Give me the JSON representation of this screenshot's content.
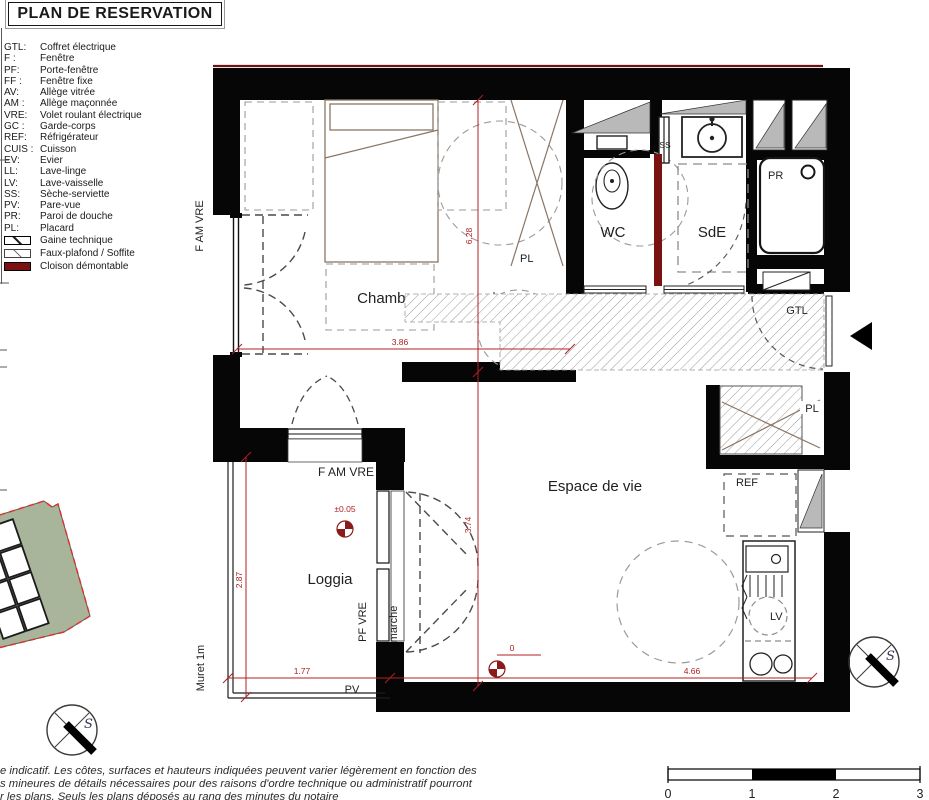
{
  "title": "PLAN DE RESERVATION",
  "legend": {
    "items": [
      {
        "abbr": "GTL:",
        "label": "Coffret électrique"
      },
      {
        "abbr": "F :",
        "label": "Fenêtre"
      },
      {
        "abbr": "PF:",
        "label": "Porte-fenêtre"
      },
      {
        "abbr": "FF :",
        "label": "Fenêtre fixe"
      },
      {
        "abbr": "AV:",
        "label": "Allège vitrée"
      },
      {
        "abbr": "AM :",
        "label": "Allège maçonnée"
      },
      {
        "abbr": "VRE:",
        "label": "Volet roulant électrique"
      },
      {
        "abbr": "GC :",
        "label": "Garde-corps"
      },
      {
        "abbr": "REF:",
        "label": "Réfrigérateur"
      },
      {
        "abbr": "CUIS :",
        "label": "Cuisson"
      },
      {
        "abbr": "EV:",
        "label": "Evier"
      },
      {
        "abbr": "LL:",
        "label": "Lave-linge"
      },
      {
        "abbr": "LV:",
        "label": "Lave-vaisselle"
      },
      {
        "abbr": "SS:",
        "label": "Sèche-serviette"
      },
      {
        "abbr": "PV:",
        "label": "Pare-vue"
      },
      {
        "abbr": "PR:",
        "label": "Paroi de douche"
      },
      {
        "abbr": "PL:",
        "label": "Placard"
      }
    ],
    "swatches": [
      {
        "label": "Gaine technique"
      },
      {
        "label": "Faux-plafond / Soffite"
      },
      {
        "label": "Cloison démontable"
      }
    ]
  },
  "plan": {
    "rooms": {
      "chambre": "Chambre",
      "wc": "WC",
      "sde": "SdE",
      "espace": "Espace de vie",
      "loggia": "Loggia"
    },
    "labels": {
      "f_am_vre_left": "F AM VRE",
      "f_am_vre_loggia": "F AM VRE",
      "pl_chambre": "PL",
      "ss": "SS",
      "pr": "PR",
      "gtl": "GTL",
      "pl_entree": "PL",
      "ref": "REF",
      "lv": "LV",
      "pv": "PV",
      "pf_vre": "PF VRE",
      "marche": "marche",
      "muret": "Muret 1m",
      "compass_s": "S"
    },
    "dims": {
      "d386": "3.86",
      "d628": "6.28",
      "d374": "3.74",
      "d287": "2.87",
      "d177": "1.77",
      "d466": "4.66",
      "lvl_loggia": "±0.05",
      "lvl_espace": "0"
    },
    "colors": {
      "wall": "#060606",
      "dim_red": "#b02020",
      "cloison_red": "#7a1212",
      "soffite_gray": "#b9b9b9",
      "furniture_brown": "#8a7565",
      "site_green": "#a9b59a",
      "site_boundary_red": "#e23030",
      "unit_blue": "#2b3f96"
    }
  },
  "scalebar": {
    "t0": "0",
    "t1": "1",
    "t2": "2",
    "t3": "3"
  },
  "disclaimer": {
    "line1": "e indicatif. Les côtes, surfaces et hauteurs indiquées peuvent varier légèrement en fonction des",
    "line2": "s mineures de détails nécessaires pour des raisons d'ordre technique ou administratif pourront",
    "line3": "r les plans. Seuls les plans déposés au rang des minutes du notaire"
  }
}
